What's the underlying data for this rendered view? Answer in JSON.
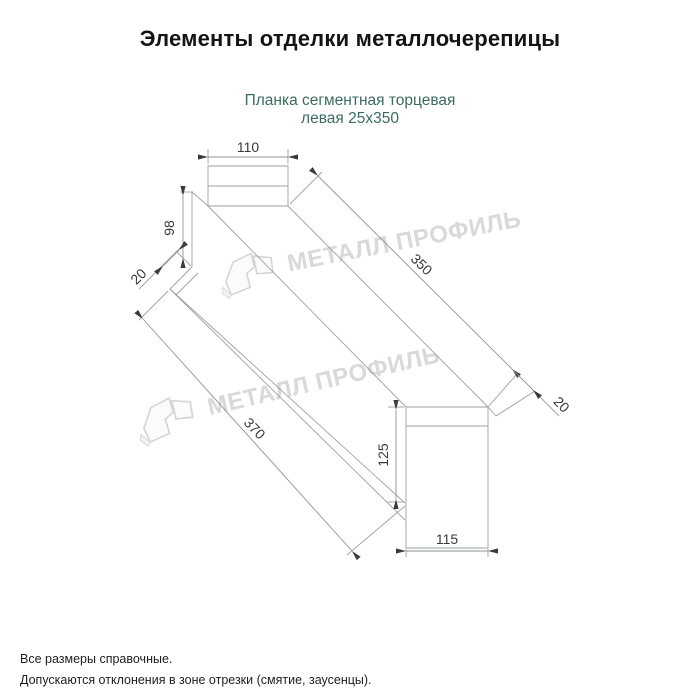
{
  "header": {
    "title": "Элементы отделки металлочерепицы"
  },
  "product": {
    "name_line1": "Планка сегментная торцевая",
    "name_line2": "левая 25x350",
    "name_color": "#3c6b60"
  },
  "drawing": {
    "type": "technical-dimension-drawing",
    "line_color": "#9ba1a5",
    "dim_text_color": "#3a3a3a",
    "dims": {
      "top_width": "110",
      "left_height": "98",
      "left_fold": "20",
      "length_top": "350",
      "length_bottom": "370",
      "right_fold": "20",
      "right_height": "125",
      "bottom_width": "115"
    }
  },
  "watermark": {
    "text": "МЕТАЛЛ ПРОФИЛЬ",
    "color": "#d7dad9"
  },
  "footer": {
    "note1": "Все размеры справочные.",
    "note2": "Допускаются отклонения в зоне отрезки (смятие, заусенцы)."
  }
}
